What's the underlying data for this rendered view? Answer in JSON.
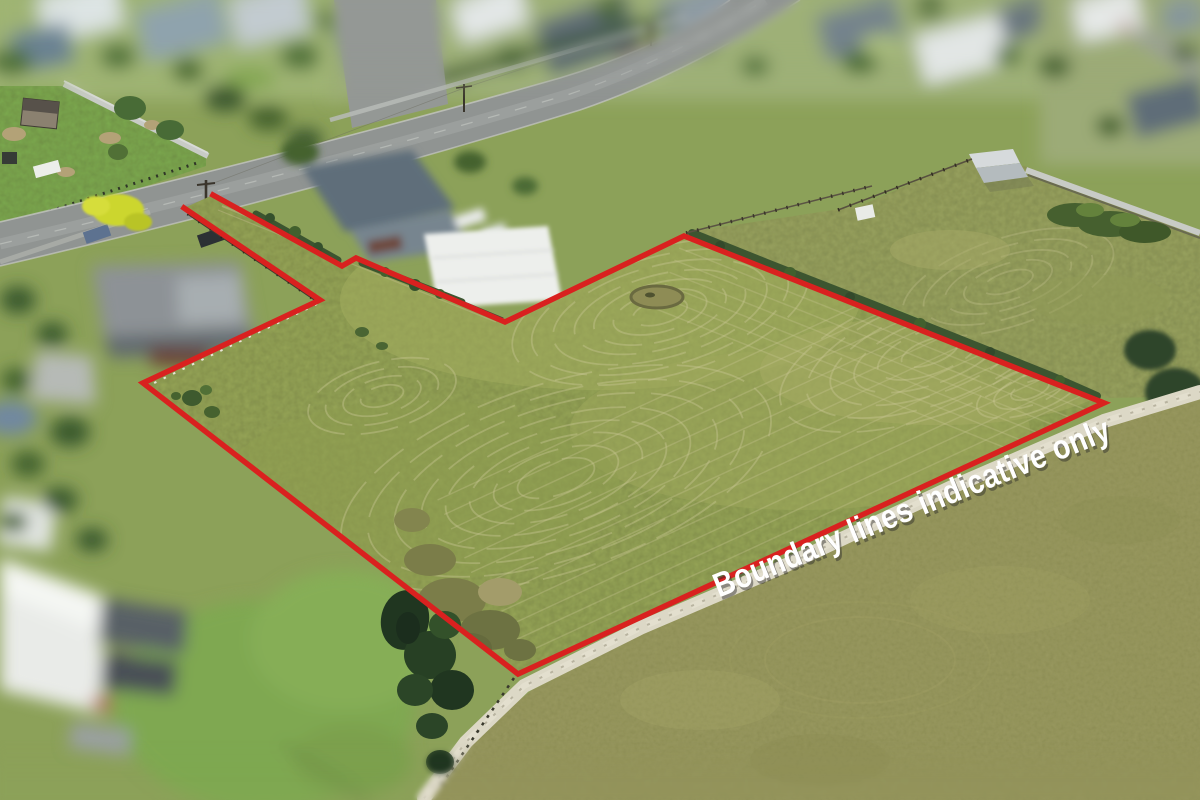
{
  "annotation": {
    "text": "Boundary lines indicative only",
    "color": "#ffffff",
    "shadow_color": "rgba(40,40,40,0.45)",
    "rotation_deg": -22,
    "font_size_px": 34,
    "text_length_px": 425,
    "center_x": 916,
    "center_y": 518
  },
  "boundary": {
    "color": "#d9211f",
    "stroke_width": 5.5,
    "closed": false,
    "points": [
      [
        213,
        195
      ],
      [
        342,
        266
      ],
      [
        356,
        258
      ],
      [
        505,
        322
      ],
      [
        684,
        236
      ],
      [
        1104,
        403
      ],
      [
        518,
        674
      ],
      [
        143,
        383
      ],
      [
        320,
        300
      ],
      [
        184,
        208
      ]
    ]
  },
  "scene": {
    "palette": {
      "base_green": "#8ca159",
      "paddock": "#95a457",
      "neighbor_field": "#98a25e",
      "dry_field": "#9a9a60",
      "lawn": "#7ca94f",
      "road": "#909492",
      "track": "#dcd8c6",
      "hedge": "#3c5530",
      "swirl": "#cbc795",
      "pond": "#203620",
      "wall": "#c8cbc6"
    },
    "swirls": [
      {
        "cx": 660,
        "cy": 312,
        "rot": -15,
        "ratio": 0.42,
        "radii": [
          28,
          48,
          68,
          88,
          110,
          132,
          152
        ]
      },
      {
        "cx": 556,
        "cy": 478,
        "rot": -18,
        "ratio": 0.42,
        "radii": [
          40,
          65,
          90,
          115,
          140,
          168,
          196,
          224
        ]
      },
      {
        "cx": 930,
        "cy": 352,
        "rot": -20,
        "ratio": 0.4,
        "radii": [
          30,
          55,
          80,
          105,
          130,
          158
        ]
      },
      {
        "cx": 382,
        "cy": 396,
        "rot": -15,
        "ratio": 0.45,
        "radii": [
          22,
          40,
          58,
          76
        ]
      },
      {
        "cx": 1030,
        "cy": 390,
        "rot": -20,
        "ratio": 0.4,
        "radii": [
          20,
          38,
          56
        ]
      }
    ],
    "ne_swirl": {
      "cx": 1008,
      "cy": 282,
      "rot": -18,
      "ratio": 0.4,
      "radii": [
        26,
        46,
        66,
        88,
        110
      ]
    },
    "windrows": [
      {
        "x1": 1104,
        "y1": 403,
        "x2": 518,
        "y2": 674,
        "sx": -6.7,
        "sy": -14.5,
        "count": 12,
        "opacity": 0.32
      },
      {
        "x1": 684,
        "y1": 236,
        "x2": 1104,
        "y2": 403,
        "sx": -4.8,
        "sy": 12.1,
        "count": 6,
        "opacity": 0.3
      }
    ]
  }
}
